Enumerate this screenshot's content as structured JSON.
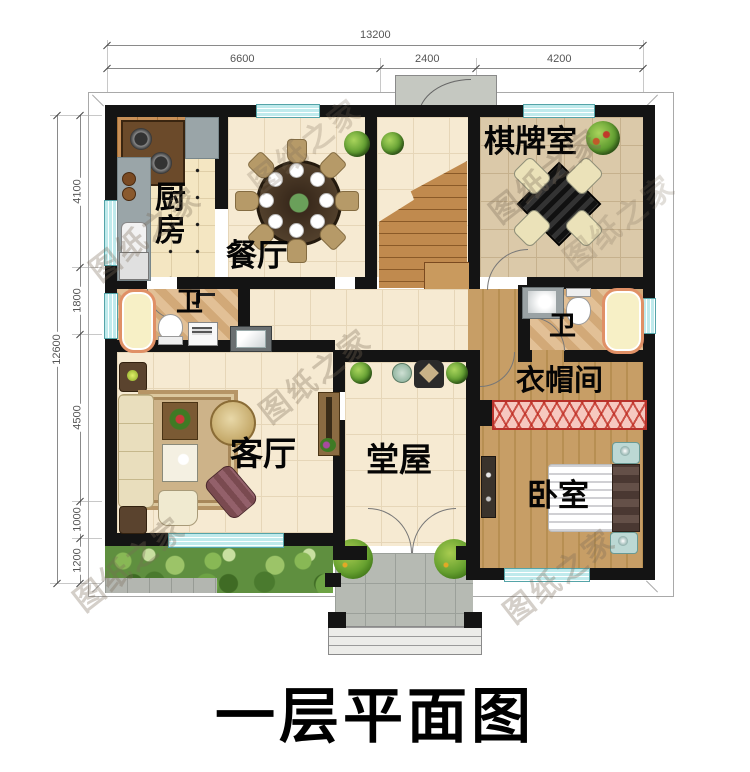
{
  "title": "一层平面图",
  "watermark": "图纸之家",
  "dimensions": {
    "top": {
      "total": "13200",
      "seg1": "6600",
      "seg2": "2400",
      "seg3": "4200"
    },
    "left": {
      "total": "12600",
      "seg1": "4100",
      "seg2": "1800",
      "seg3": "4500",
      "seg4": "1000",
      "seg5": "1200"
    }
  },
  "rooms": {
    "kitchen": "厨房",
    "dining": "餐厅",
    "chess": "棋牌室",
    "bath_left": "卫",
    "bath_right": "卫",
    "living": "客厅",
    "hall": "堂屋",
    "cloak": "衣帽间",
    "bedroom": "卧室"
  },
  "colors": {
    "wall": "#141414",
    "window": "#bfeaec",
    "wardrobe_red": "#b8312a"
  }
}
